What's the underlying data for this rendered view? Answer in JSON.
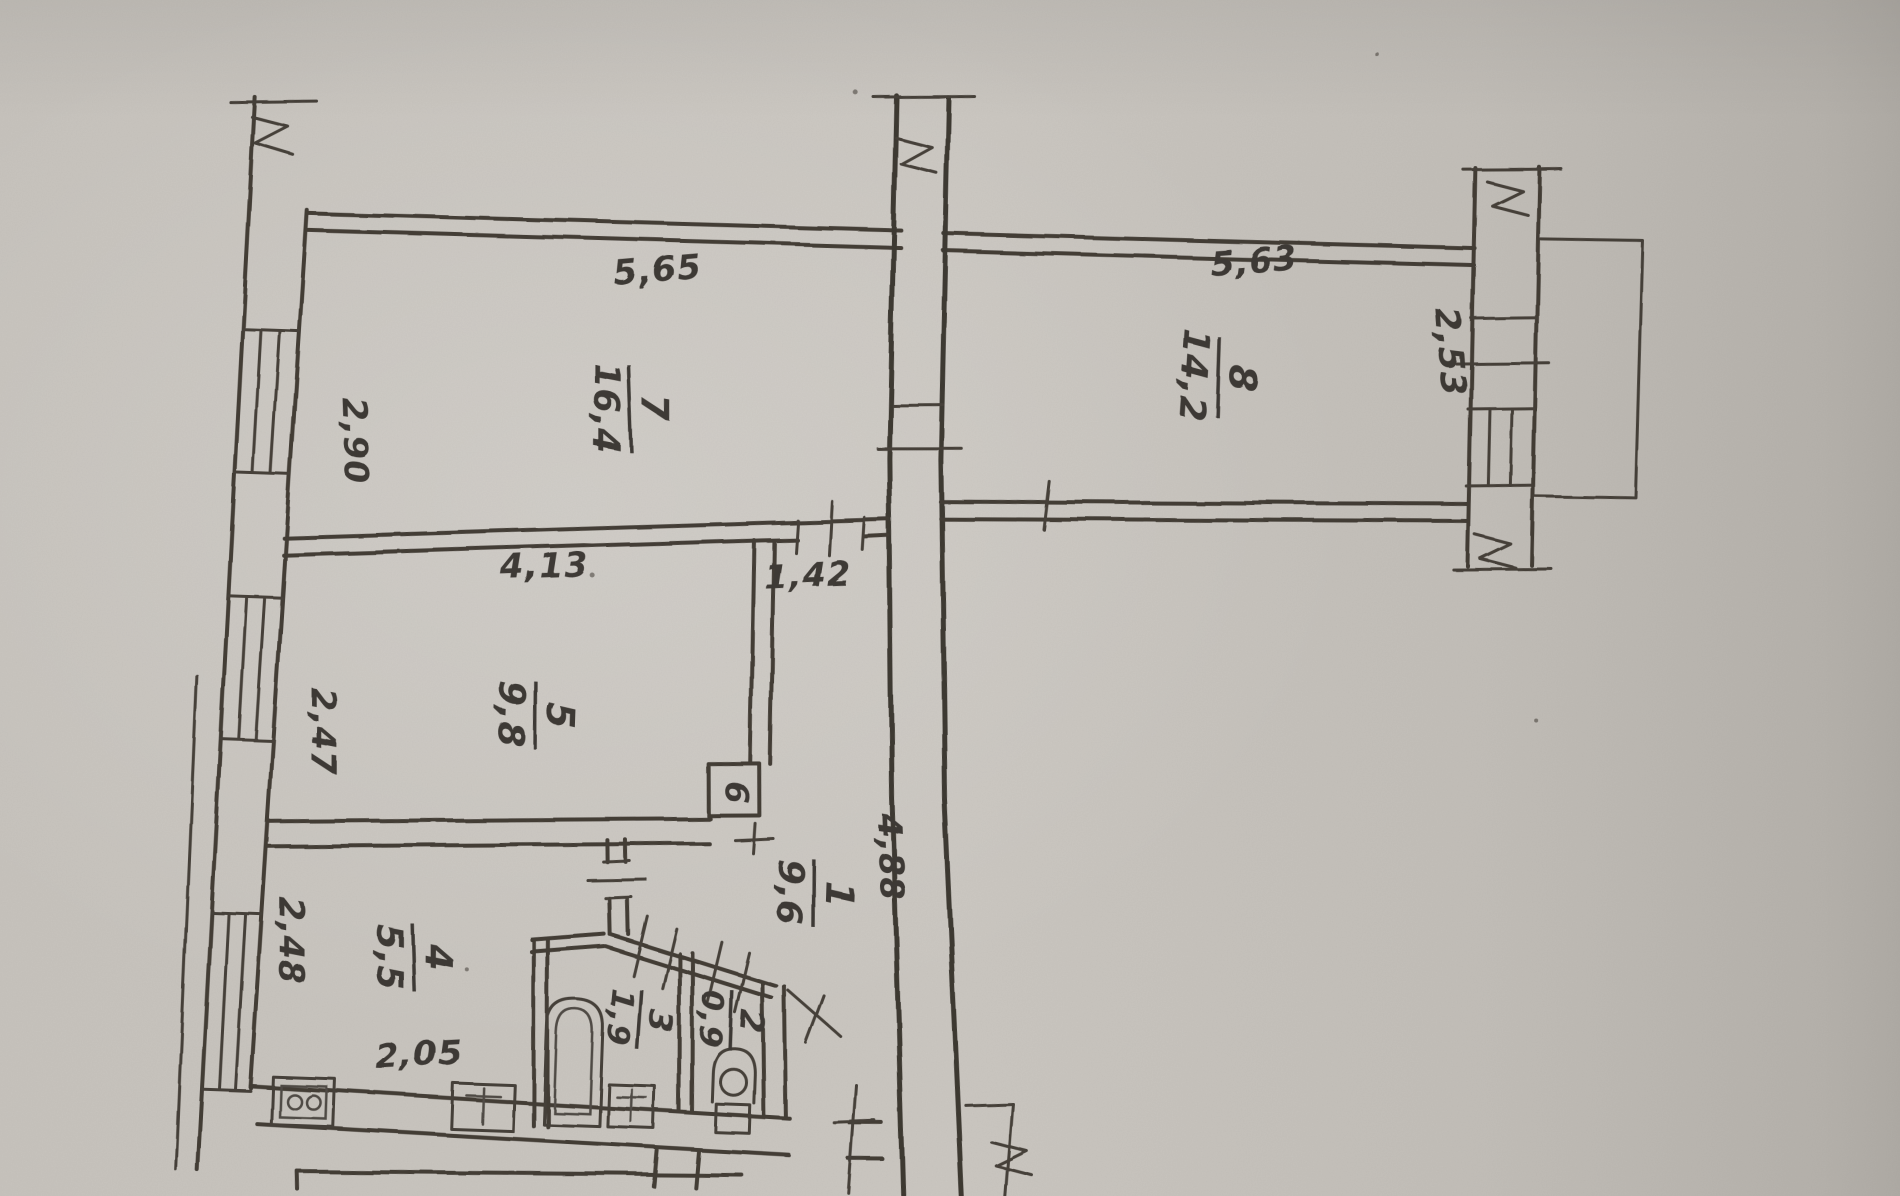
{
  "colors": {
    "paper": "#c9c5bf",
    "ink": "#37322c"
  },
  "rooms": [
    {
      "number": "7",
      "area": "16,4"
    },
    {
      "number": "8",
      "area": "14,2"
    },
    {
      "number": "5",
      "area": "9,8"
    },
    {
      "number": "1",
      "area": "9,6"
    },
    {
      "number": "4",
      "area": "5,5"
    },
    {
      "number": "3",
      "area": "1,9"
    },
    {
      "number": "2",
      "area": "0,9"
    },
    {
      "number": "6",
      "area": ""
    }
  ],
  "dimensions": {
    "room7_top": "5,65",
    "room8_top": "5,63",
    "room7_left": "2,90",
    "room5_top": "4,13",
    "room5_left": "2,47",
    "hall_opening": "1,42",
    "hall_side": "4,88",
    "kitchen_left": "2,48",
    "kitchen_bottom": "2,05",
    "room8_right": "2,53"
  },
  "icons": {
    "fixtures": [
      "stove-icon",
      "kitchen-sink-icon",
      "bathtub-icon",
      "bath-sink-icon",
      "toilet-icon"
    ]
  }
}
